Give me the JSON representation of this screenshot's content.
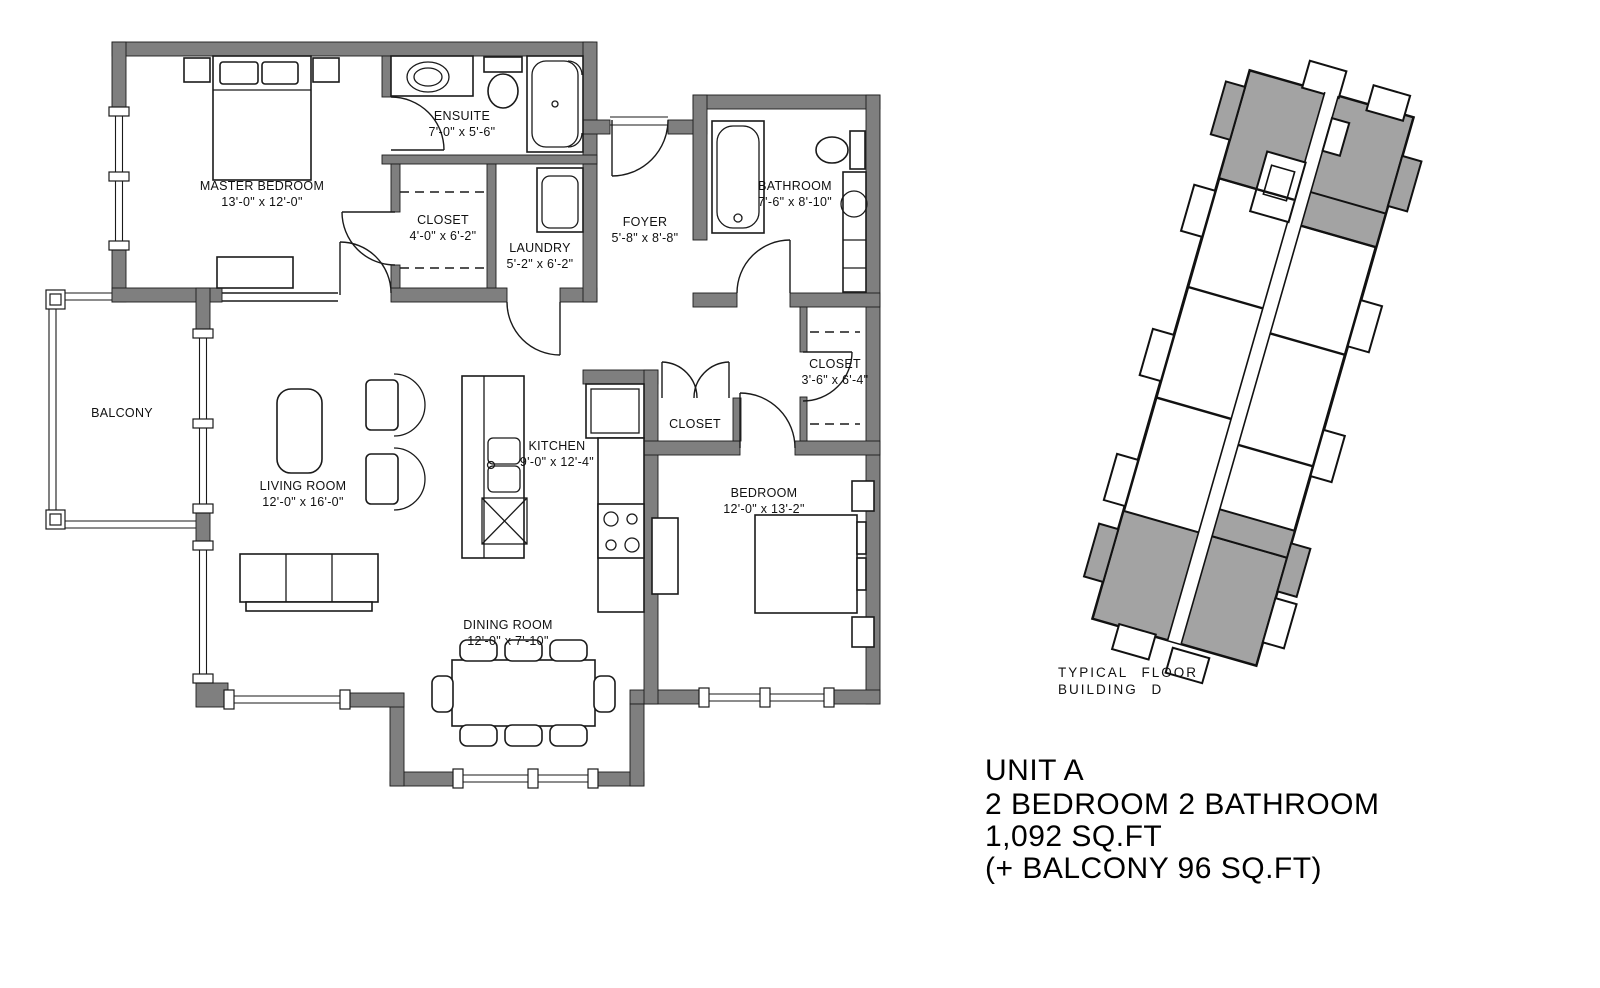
{
  "floor_plan": {
    "rooms": {
      "master_bedroom": {
        "name": "MASTER BEDROOM",
        "dims": "13'-0\" x 12'-0\""
      },
      "ensuite": {
        "name": "ENSUITE",
        "dims": "7'-0\" x 5'-6\""
      },
      "closet_master": {
        "name": "CLOSET",
        "dims": "4'-0\" x 6'-2\""
      },
      "laundry": {
        "name": "LAUNDRY",
        "dims": "5'-2\" x 6'-2\""
      },
      "foyer": {
        "name": "FOYER",
        "dims": "5'-8\" x 8'-8\""
      },
      "bathroom": {
        "name": "BATHROOM",
        "dims": "7'-6\" x 8'-10\""
      },
      "closet_hall": {
        "name": "CLOSET"
      },
      "closet_bedroom": {
        "name": "CLOSET",
        "dims": "3'-6\" x 6'-4\""
      },
      "bedroom": {
        "name": "BEDROOM",
        "dims": "12'-0\" x 13'-2\""
      },
      "kitchen": {
        "name": "KITCHEN",
        "dims": "9'-0\" x 12'-4\""
      },
      "living_room": {
        "name": "LIVING ROOM",
        "dims": "12'-0\" x 16'-0\""
      },
      "dining_room": {
        "name": "DINING ROOM",
        "dims": "12'-0\" x 7'-10\""
      },
      "balcony": {
        "name": "BALCONY"
      }
    }
  },
  "site_plan": {
    "caption_line1": "TYPICAL FLOOR",
    "caption_line2": "BUILDING D"
  },
  "title_block": {
    "line1": "UNIT A",
    "line2": "2 BEDROOM 2 BATHROOM",
    "line3": "1,092 SQ.FT",
    "line4": "(+ BALCONY 96 SQ.FT)"
  },
  "colors": {
    "wall": "#7f7f7f",
    "line": "#1a1a1a",
    "unit_highlight": "#a3a3a3",
    "background": "#ffffff"
  }
}
